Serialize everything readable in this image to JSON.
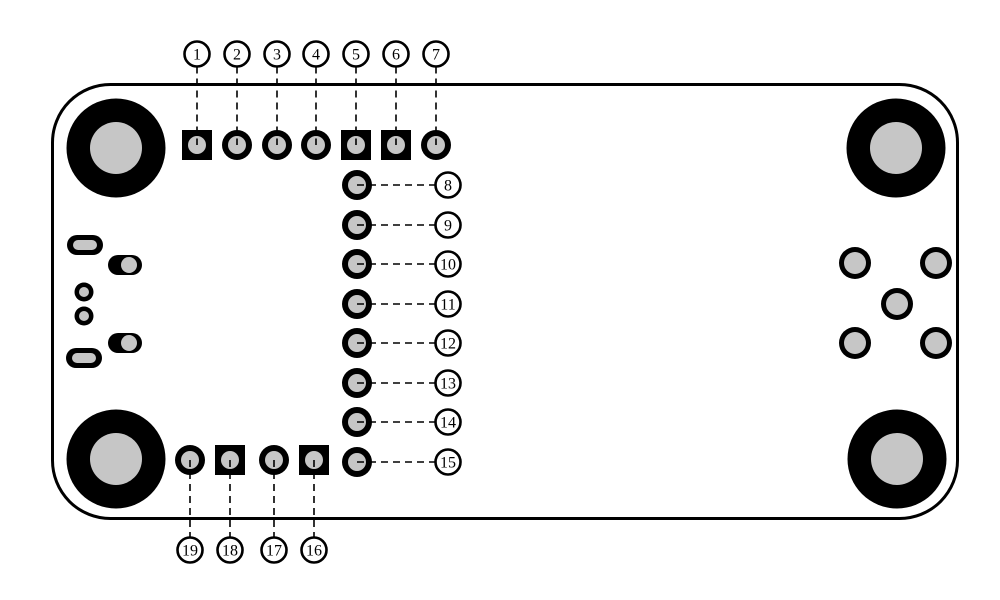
{
  "diagram": {
    "type": "pcb-pinout",
    "colors": {
      "background": "#ffffff",
      "ink": "#000000",
      "hole": "#c6c6c6",
      "label_fill": "#ffffff"
    },
    "board": {
      "x": 52.5,
      "y": 84.5,
      "width": 905,
      "height": 434,
      "corner_radius": 58,
      "stroke_width": 3
    },
    "mount_hole_style": {
      "outer_r": 49.5,
      "inner_r": 26
    },
    "mount_holes": [
      {
        "cx": 116,
        "cy": 148
      },
      {
        "cx": 896,
        "cy": 148
      },
      {
        "cx": 116,
        "cy": 459
      },
      {
        "cx": 897,
        "cy": 459
      }
    ],
    "pad_style": {
      "round_r": 15,
      "square_size": 30,
      "hole_r": 9
    },
    "label_style": {
      "r": 12.5,
      "stroke_width": 2.6,
      "font_size": 16
    },
    "leader_style": {
      "dash": "7 5",
      "width": 1.6
    },
    "pins": [
      {
        "num": "1",
        "pad_x": 197,
        "pad_y": 145,
        "shape": "square",
        "label_x": 197,
        "label_y": 54
      },
      {
        "num": "2",
        "pad_x": 237,
        "pad_y": 145,
        "shape": "round",
        "label_x": 237,
        "label_y": 54
      },
      {
        "num": "3",
        "pad_x": 277,
        "pad_y": 145,
        "shape": "round",
        "label_x": 277,
        "label_y": 54
      },
      {
        "num": "4",
        "pad_x": 316,
        "pad_y": 145,
        "shape": "round",
        "label_x": 316,
        "label_y": 54
      },
      {
        "num": "5",
        "pad_x": 356,
        "pad_y": 145,
        "shape": "square",
        "label_x": 356,
        "label_y": 54
      },
      {
        "num": "6",
        "pad_x": 396,
        "pad_y": 145,
        "shape": "square",
        "label_x": 396,
        "label_y": 54
      },
      {
        "num": "7",
        "pad_x": 436,
        "pad_y": 145,
        "shape": "round",
        "label_x": 436,
        "label_y": 54
      },
      {
        "num": "8",
        "pad_x": 357,
        "pad_y": 185,
        "shape": "round",
        "label_x": 448,
        "label_y": 185
      },
      {
        "num": "9",
        "pad_x": 357,
        "pad_y": 225,
        "shape": "round",
        "label_x": 448,
        "label_y": 225
      },
      {
        "num": "10",
        "pad_x": 357,
        "pad_y": 264,
        "shape": "round",
        "label_x": 448,
        "label_y": 264
      },
      {
        "num": "11",
        "pad_x": 357,
        "pad_y": 304,
        "shape": "round",
        "label_x": 448,
        "label_y": 304
      },
      {
        "num": "12",
        "pad_x": 357,
        "pad_y": 343,
        "shape": "round",
        "label_x": 448,
        "label_y": 343
      },
      {
        "num": "13",
        "pad_x": 357,
        "pad_y": 383,
        "shape": "round",
        "label_x": 448,
        "label_y": 383
      },
      {
        "num": "14",
        "pad_x": 357,
        "pad_y": 422,
        "shape": "round",
        "label_x": 448,
        "label_y": 422
      },
      {
        "num": "15",
        "pad_x": 357,
        "pad_y": 462,
        "shape": "round",
        "label_x": 448,
        "label_y": 462
      },
      {
        "num": "16",
        "pad_x": 314,
        "pad_y": 460,
        "shape": "square",
        "label_x": 314,
        "label_y": 550
      },
      {
        "num": "17",
        "pad_x": 274,
        "pad_y": 460,
        "shape": "round",
        "label_x": 274,
        "label_y": 550
      },
      {
        "num": "18",
        "pad_x": 230,
        "pad_y": 460,
        "shape": "square",
        "label_x": 230,
        "label_y": 550
      },
      {
        "num": "19",
        "pad_x": 190,
        "pad_y": 460,
        "shape": "round",
        "label_x": 190,
        "label_y": 550
      }
    ],
    "usb_connector": {
      "oval_style": {
        "w": 36,
        "h": 20,
        "slot_w": 24,
        "slot_h": 10
      },
      "oval_pads": [
        {
          "cx": 85,
          "cy": 245
        },
        {
          "cx": 84,
          "cy": 358
        }
      ],
      "capsule_style": {
        "w": 34,
        "h": 20,
        "hole_r": 8,
        "hole_dx": 4
      },
      "capsule_pads": [
        {
          "cx": 125,
          "cy": 265
        },
        {
          "cx": 125,
          "cy": 343
        }
      ],
      "small_hole_style": {
        "outer_r": 9.5,
        "inner_r": 5
      },
      "small_holes": [
        {
          "cx": 84,
          "cy": 292
        },
        {
          "cx": 84,
          "cy": 316
        }
      ]
    },
    "right_cluster": {
      "style": {
        "outer_r": 16,
        "inner_r": 11
      },
      "holes": [
        {
          "cx": 855,
          "cy": 263
        },
        {
          "cx": 936,
          "cy": 263
        },
        {
          "cx": 897,
          "cy": 304
        },
        {
          "cx": 855,
          "cy": 343
        },
        {
          "cx": 936,
          "cy": 343
        }
      ]
    }
  }
}
